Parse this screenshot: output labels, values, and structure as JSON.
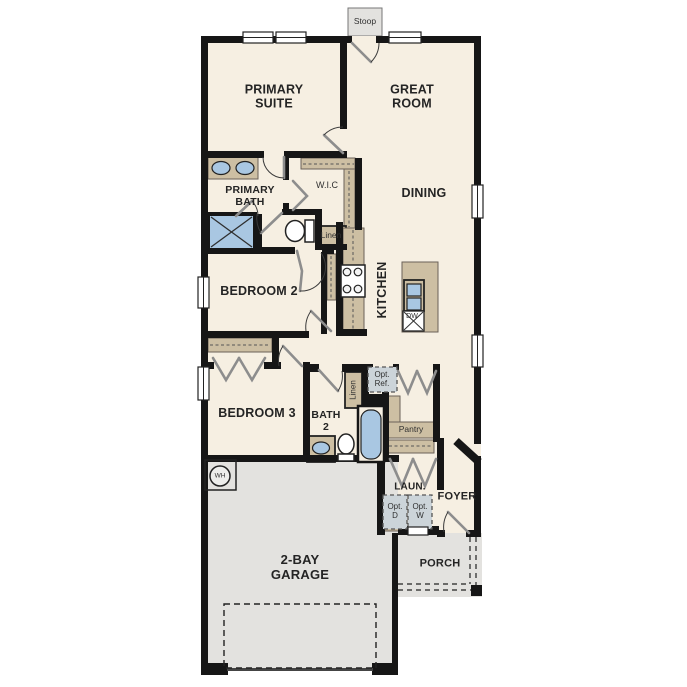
{
  "title": "Single-story home floor plan",
  "colors": {
    "wall": "#161616",
    "floor": "#f6efe2",
    "concrete": "#e3e2df",
    "cabinet": "#cdbfa3",
    "plumbing_fixture": "#a9c7e2",
    "optional_item_fill": "#ccd4d9"
  },
  "labels": {
    "stoop": "Stoop",
    "primary_suite": "PRIMARY\nSUITE",
    "great_room": "GREAT\nROOM",
    "primary_bath": "PRIMARY\nBATH",
    "wic": "W.I.C",
    "dining": "DINING",
    "linen_upper": "Linen",
    "bedroom2": "BEDROOM 2",
    "kitchen": "KITCHEN",
    "dishwasher": "DW",
    "bedroom3": "BEDROOM 3",
    "bath2": "BATH\n2",
    "linen_lower": "Linen",
    "opt_ref": "Opt.\nRef.",
    "pantry": "Pantry",
    "water_heater": "WH",
    "laundry": "LAUN.",
    "opt_dryer": "Opt.\nD",
    "opt_washer": "Opt.\nW",
    "foyer": "FOYER",
    "garage": "2-BAY\nGARAGE",
    "porch": "PORCH"
  }
}
